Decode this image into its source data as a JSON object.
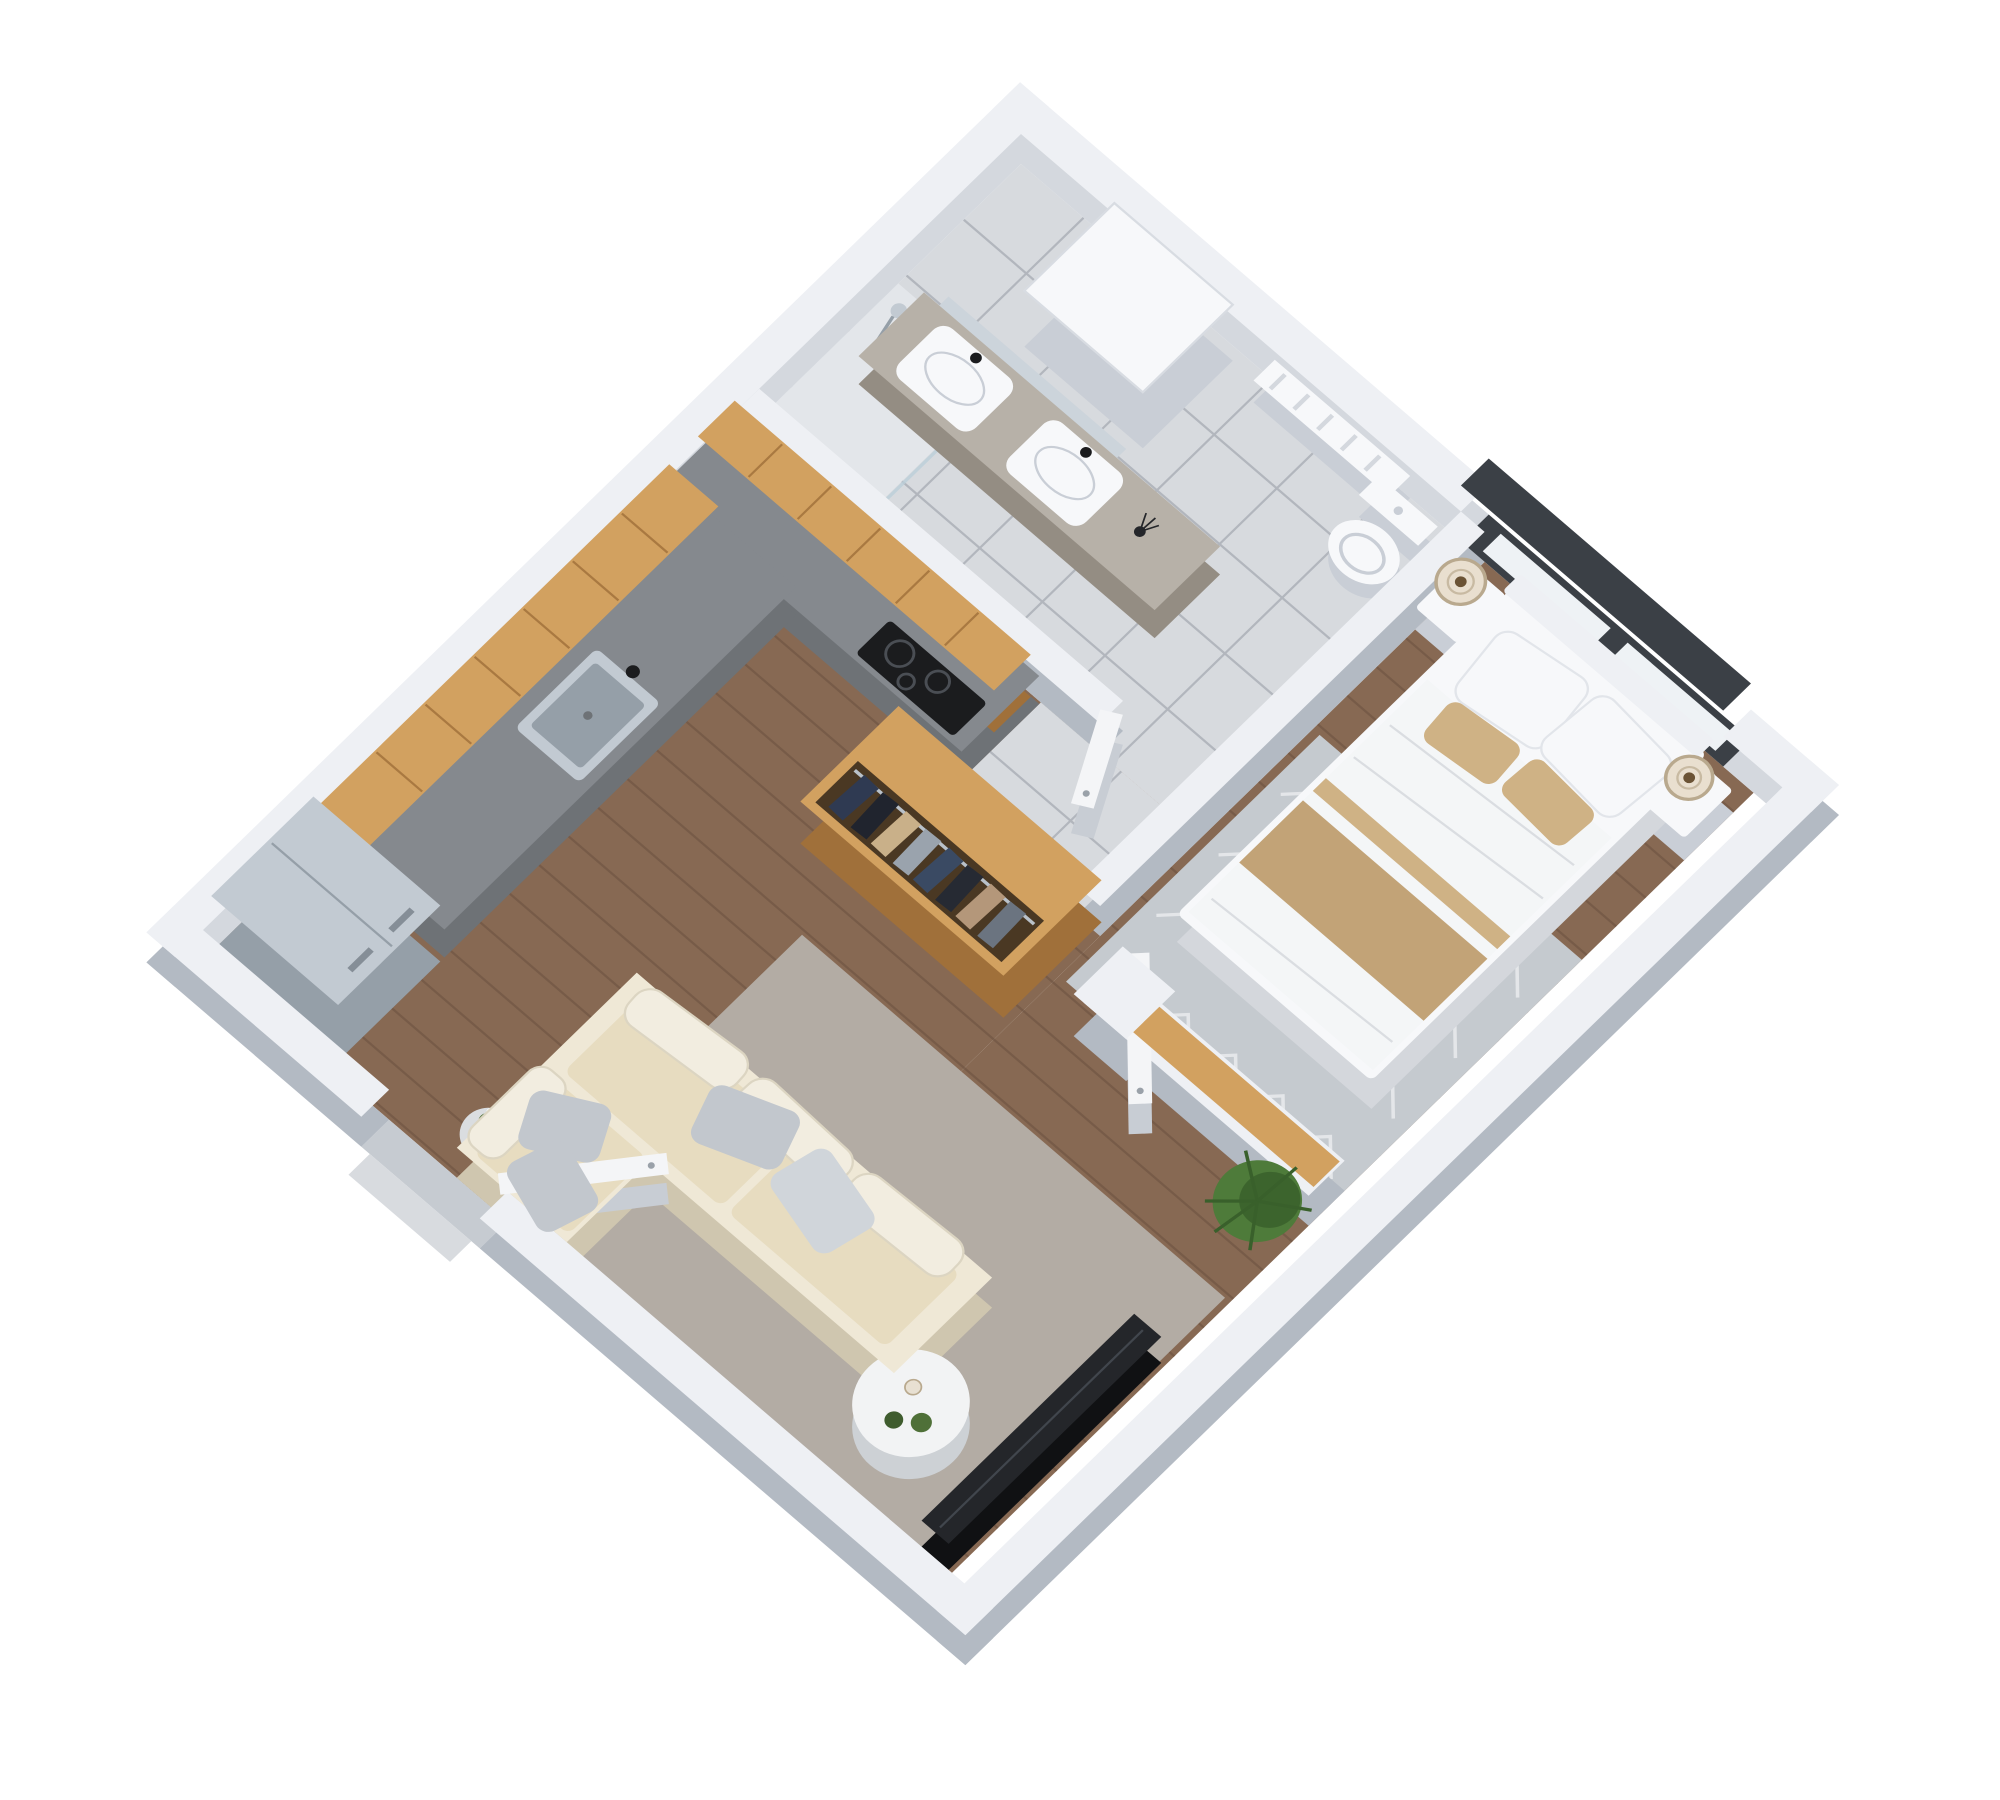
{
  "scene": {
    "type": "isometric-3d-floor-plan",
    "style": "architectural render, white background, top-down dimetric view",
    "rooms": [
      {
        "name": "bathroom",
        "items": [
          "tile-floor",
          "vanity-counter",
          "sink-left",
          "sink-right",
          "mirror",
          "diffuser",
          "shelf-unit",
          "towel-radiator",
          "toilet",
          "shower"
        ]
      },
      {
        "name": "kitchen",
        "items": [
          "upper-cabinets-top-leg",
          "upper-cabinets-left-leg",
          "granite-countertop",
          "kitchen-sink",
          "induction-cooktop",
          "fridge"
        ]
      },
      {
        "name": "hallway",
        "items": [
          "tile-floor",
          "entrance-door",
          "bathroom-door",
          "wardrobe-with-clothes"
        ]
      },
      {
        "name": "bedroom",
        "items": [
          "wood-floor",
          "double-bed",
          "pillows",
          "tan-throw",
          "nightstand-left",
          "nightstand-right",
          "table-lamp-left",
          "table-lamp-right",
          "chevron-rug",
          "window",
          "bedroom-door",
          "divider-bench",
          "fern-plant"
        ]
      },
      {
        "name": "living-room",
        "items": [
          "wood-floor",
          "corner-sofa",
          "sofa-cushions",
          "gray-pillows",
          "area-rug",
          "coffee-table",
          "tv-panel",
          "flower-pot"
        ]
      }
    ]
  },
  "palette": {
    "bg": "#ffffff",
    "wallTop": "#eef0f4",
    "wallSideLight": "#d4d8de",
    "wallSideDark": "#b3bac3",
    "tile": "#d7dade",
    "tileShower": "#e3e6ea",
    "grout": "#a9aeb6",
    "wood": "#87695397",
    "woodBase": "#876953",
    "woodLine": "#654c3c",
    "oakTop": "#d2a160",
    "oakSide": "#a0703a",
    "granite": "#85898e",
    "graniteSide": "#6e7276",
    "steel": "#c2cad2",
    "steelSide": "#959fa8",
    "black": "#1b1c1e",
    "cooktopRing": "#4a4e54",
    "white": "#f7f8fa",
    "furnSideWhite": "#c9ced6",
    "bedSide": "#d4d7dc",
    "cream": "#efe8d6",
    "creamSide": "#cfc6af",
    "cushion": "#e7dcc0",
    "bolster": "#f2ede0",
    "bolsterEdge": "#dcd5c2",
    "pillowGray": "#c2c7cd",
    "pillowGrayLight": "#d0d5da",
    "tan": "#c2a377",
    "tanLight": "#cfb285",
    "rugBedroom": "#c5cacf",
    "rugLiving": "#b3aca4",
    "rugLine": "#e8eaec",
    "lampShade": "#e9dfcf",
    "lampRing": "#b9a98e",
    "lampCore": "#6b5335",
    "plantGreen": "#4e7b3a",
    "plantDark": "#39602b",
    "doorWhite": "#f4f5f7",
    "doorSide": "#c8cdd4",
    "handle": "#9aa1a9",
    "windowFrame": "#3b4046",
    "glass": "#eef2f5",
    "marble": "#f2f3f4",
    "marbleSide": "#cdd1d5",
    "vanityTop": "#b7b1a8",
    "vanitySide": "#948d83",
    "mirror": "#ccd4db",
    "wardrobeInterior": "#4a3823",
    "rod": "#b9c1c9",
    "tvTop": "#24262a",
    "tvSide": "#101113",
    "tvLine": "#41464d",
    "potGray": "#dadde0",
    "potEdge": "#b9bfc6",
    "bowlGreen1": "#4f7038",
    "bowlGreen2": "#3f5c2e",
    "candle": "#e8e0d2",
    "step": "#c6cbd1",
    "stepOuter": "#d8dbdf",
    "clothes": {
      "c1": "#2f3a52",
      "c2": "#20242e",
      "c3": "#c9b089",
      "c4": "#9aa3ad",
      "c5": "#3a4a63",
      "c6": "#262a33",
      "c7": "#b4977a",
      "c8": "#6b7480"
    }
  }
}
